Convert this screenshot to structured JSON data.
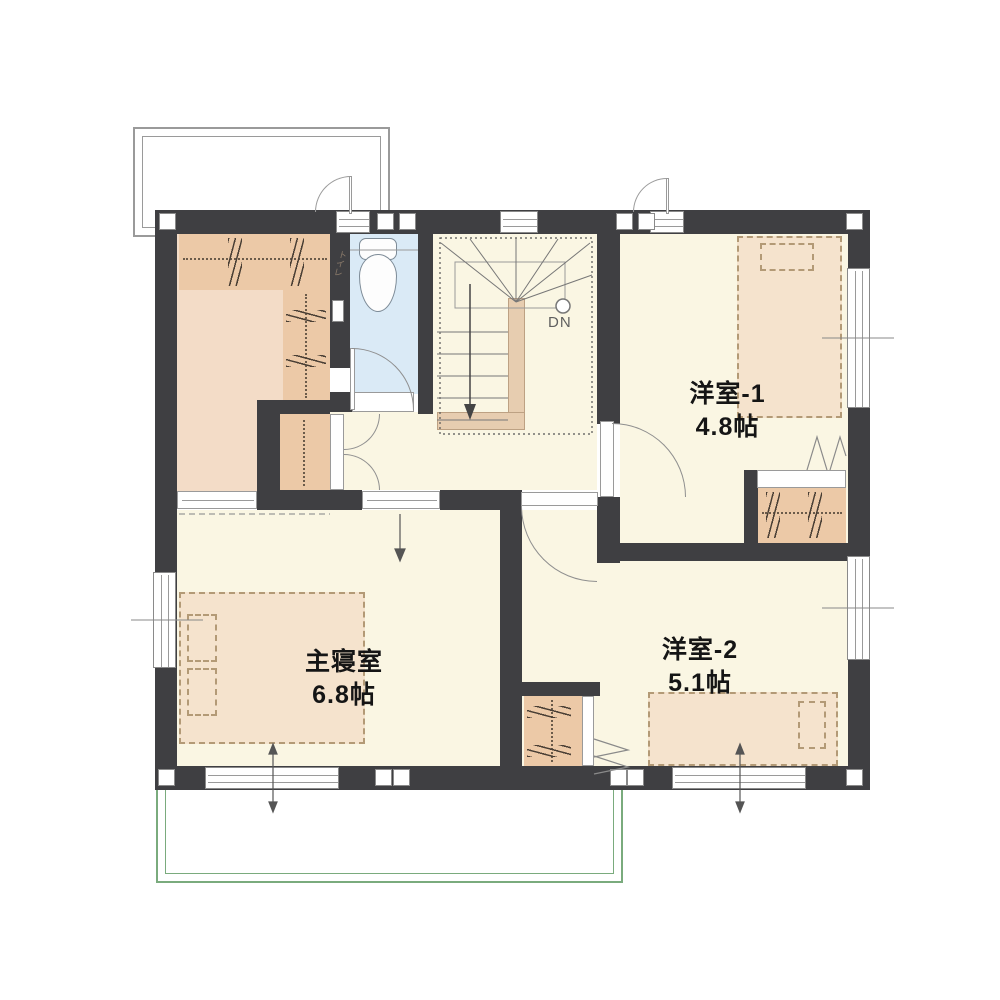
{
  "floor_plan": {
    "rooms": {
      "western_room_1": {
        "name": "洋室-1",
        "area": "4.8帖"
      },
      "western_room_2": {
        "name": "洋室-2",
        "area": "5.1帖"
      },
      "master_bedroom": {
        "name": "主寝室",
        "area": "6.8帖"
      },
      "toilet": {
        "name": "トイレ"
      },
      "stairs": {
        "label": "DN"
      }
    },
    "colors": {
      "wall": "#3f3f42",
      "floor": "#faf6e3",
      "wic_floor": "#f3dcc7",
      "toilet_floor": "#daeaf6",
      "closet": "#ecc9a7",
      "bed": "#f5e3cd",
      "balcony_outline": "#7aab7d",
      "roof_outline": "#9a9a9a",
      "line": "#8a8a8a"
    }
  }
}
